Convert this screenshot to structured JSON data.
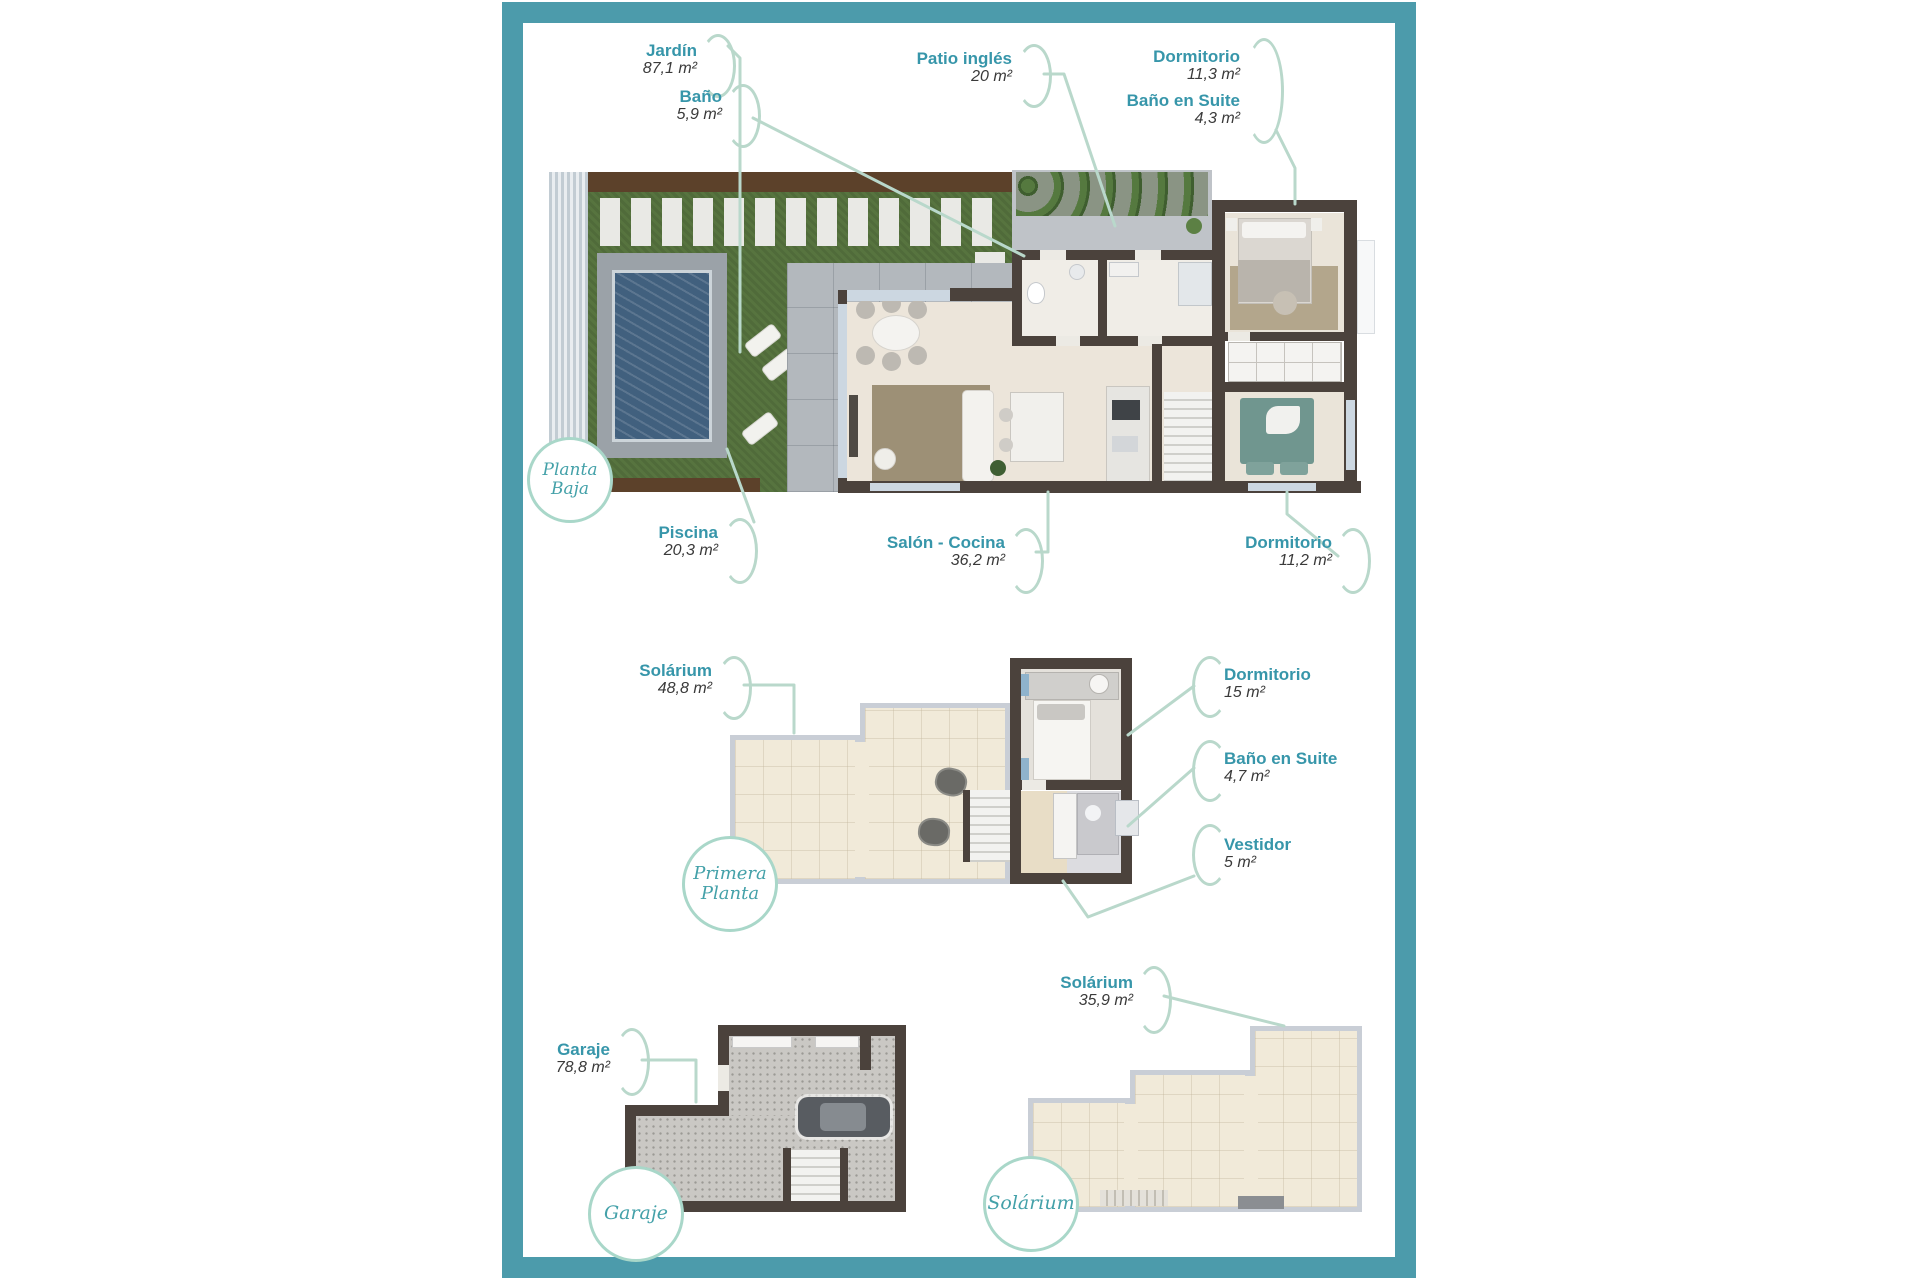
{
  "colors": {
    "frame_teal": "#4c9bab",
    "label_teal": "#3796aa",
    "area_text": "#3a3a3a",
    "leader_line": "#b9d8cb",
    "circle_border": "#a9d7c9",
    "wall": "#4b423c",
    "grass": "#57743f",
    "pool_water": "#41607e",
    "terrace_tile": "#f1ead9"
  },
  "plans": {
    "planta_baja": {
      "circle": [
        "Planta",
        "Baja"
      ],
      "callouts": {
        "jardin": {
          "name": "Jardín",
          "area": "87,1 m²"
        },
        "bano": {
          "name": "Baño",
          "area": "5,9 m²"
        },
        "patio_ingles": {
          "name": "Patio inglés",
          "area": "20 m²"
        },
        "dormitorio1": {
          "name": "Dormitorio",
          "area": "11,3 m²"
        },
        "bano_suite": {
          "name": "Baño en Suite",
          "area": "4,3 m²"
        },
        "piscina": {
          "name": "Piscina",
          "area": "20,3 m²"
        },
        "salon_cocina": {
          "name": "Salón - Cocina",
          "area": "36,2 m²"
        },
        "dormitorio2": {
          "name": "Dormitorio",
          "area": "11,2 m²"
        }
      }
    },
    "primera_planta": {
      "circle": [
        "Primera",
        "Planta"
      ],
      "callouts": {
        "solarium": {
          "name": "Solárium",
          "area": "48,8 m²"
        },
        "dormitorio": {
          "name": "Dormitorio",
          "area": "15 m²"
        },
        "bano_suite": {
          "name": "Baño en Suite",
          "area": "4,7 m²"
        },
        "vestidor": {
          "name": "Vestidor",
          "area": "5 m²"
        }
      }
    },
    "garaje": {
      "circle": [
        "Garaje"
      ],
      "callouts": {
        "garaje": {
          "name": "Garaje",
          "area": "78,8 m²"
        }
      }
    },
    "solarium": {
      "circle": [
        "Solárium"
      ],
      "callouts": {
        "solarium": {
          "name": "Solárium",
          "area": "35,9 m²"
        }
      }
    }
  }
}
